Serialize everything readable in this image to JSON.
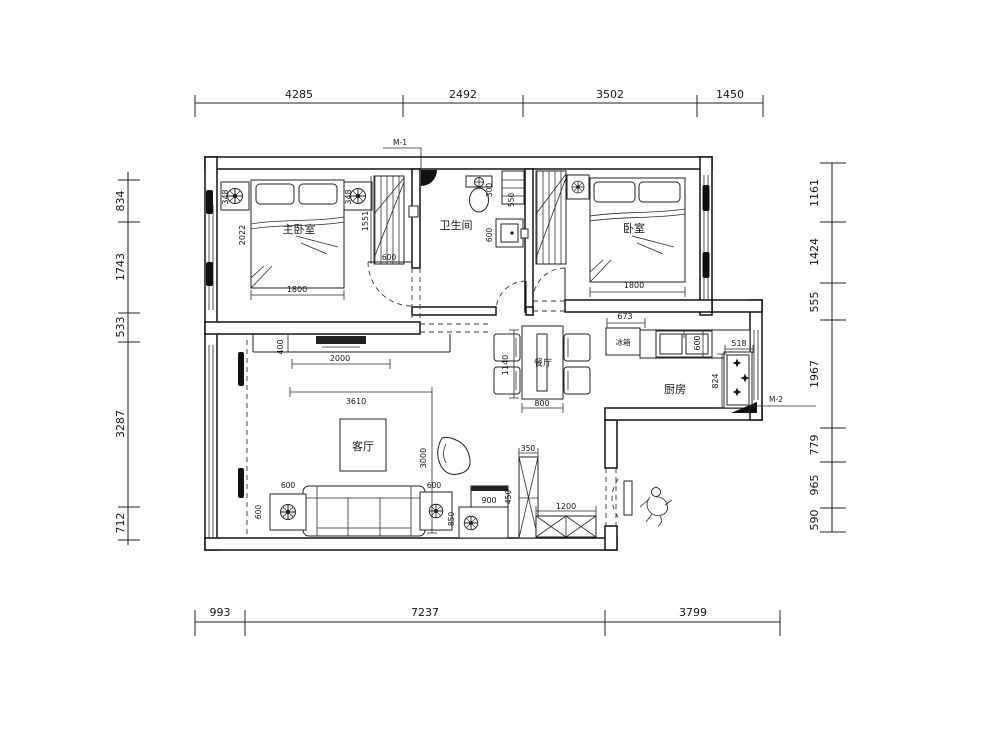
{
  "dims": {
    "top": [
      "4285",
      "2492",
      "3502",
      "1450"
    ],
    "bottom": [
      "993",
      "7237",
      "3799"
    ],
    "left": [
      "834",
      "1743",
      "533",
      "3287",
      "712"
    ],
    "right": [
      "1161",
      "1424",
      "555",
      "1967",
      "779",
      "965",
      "590"
    ],
    "interior": {
      "bed1_side_l": "348",
      "bed1_side_r": "348",
      "bed1_length": "2022",
      "bed1_width": "1800",
      "wardrobe1_depth": "1551",
      "wardrobe1_width": "600",
      "bath_toilet": "300",
      "bath_shelf": "550",
      "bath_box": "600",
      "bed2_width": "1800",
      "bed2_cabinet": "673",
      "dining_length": "1140",
      "dining_width": "800",
      "kitchen_counter": "600",
      "stove_width": "518",
      "stove_depth": "824",
      "tv_width": "2000",
      "tv_depth": "400",
      "sofa_wall": "3610",
      "living_depth": "3000",
      "table_l_a": "600",
      "table_l_b": "600",
      "table_r_a": "600",
      "table_r_b": "850",
      "cabinet_900": "900",
      "cabinet_450": "450",
      "shoe_350": "350",
      "bench_1200": "1200"
    }
  },
  "rooms": {
    "bedroom1": "主卧室",
    "bedroom2": "卧室",
    "bathroom": "卫生间",
    "dining": "餐厅",
    "living": "客厅",
    "kitchen": "厨房",
    "fridge": "冰箱"
  },
  "tags": {
    "door_top": "M-1",
    "door_kitchen": "M-2"
  }
}
